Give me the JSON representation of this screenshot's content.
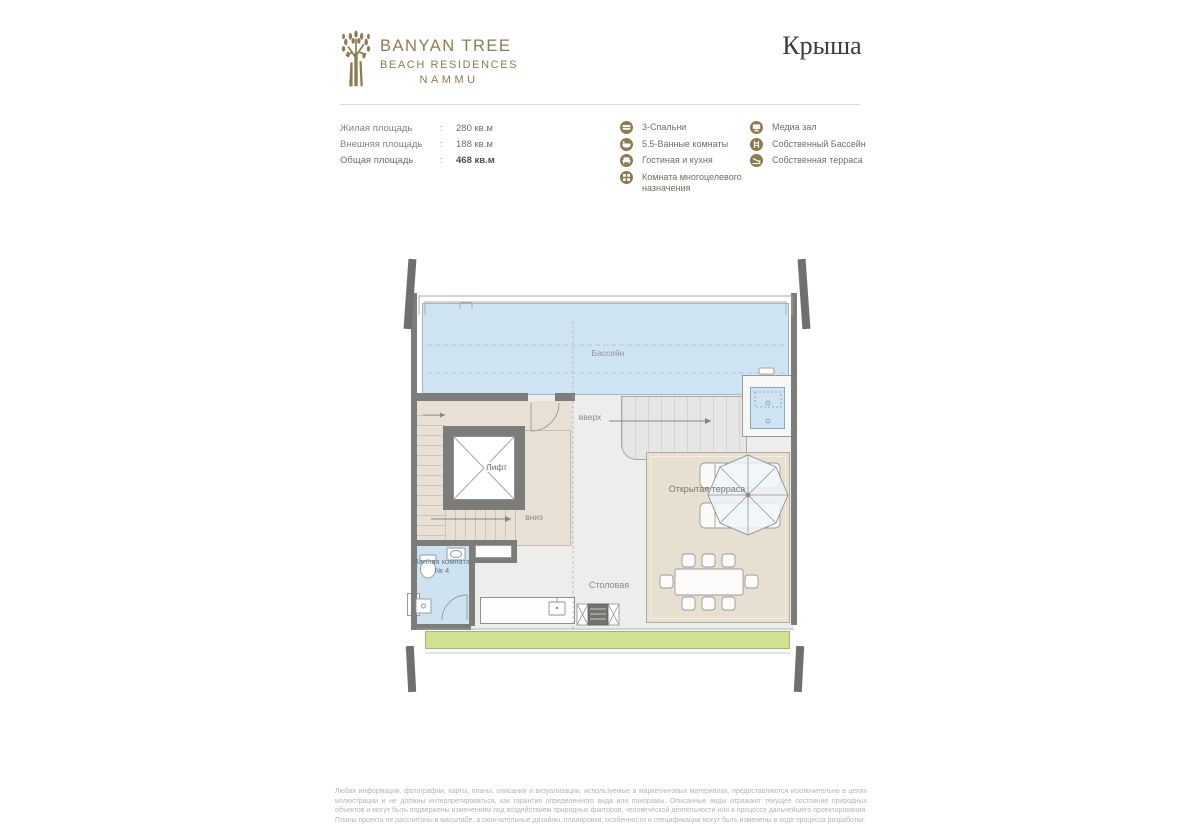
{
  "header": {
    "brand_line1": "BANYAN TREE",
    "brand_line2": "BEACH RESIDENCES",
    "brand_line3": "NAMMU",
    "title": "Крыша"
  },
  "areas": {
    "rows": [
      {
        "label": "Жилая площадь",
        "colon": ":",
        "value": "280 кв.м"
      },
      {
        "label": "Внешняя площадь",
        "colon": ":",
        "value": "188 кв.м"
      },
      {
        "label": "Общая площадь",
        "colon": ":",
        "value": "468 кв.м"
      }
    ]
  },
  "legend": {
    "left": [
      {
        "icon": "bed-icon",
        "label": "3-Спальни"
      },
      {
        "icon": "bath-icon",
        "label": "5.5-Ванные комнаты"
      },
      {
        "icon": "sofa-icon",
        "label": "Гостиная и кухня"
      },
      {
        "icon": "multipurpose-icon",
        "label": "Комната многоцелевого назначения"
      }
    ],
    "right": [
      {
        "icon": "media-icon",
        "label": "Медиа зал"
      },
      {
        "icon": "pool-icon",
        "label": "Собственный Бассейн"
      },
      {
        "icon": "terrace-icon",
        "label": "Собственная терраса"
      }
    ]
  },
  "plan": {
    "labels": {
      "pool": "Бассейн",
      "up": "вверх",
      "elevator": "Лифт",
      "down": "вниз",
      "bathroom": "Ванная комната № 4",
      "dining": "Столовая",
      "terrace": "Открытая терраса"
    }
  },
  "colors": {
    "brand_gold": "#8d7c50",
    "pool_blue": "#cfe4f2",
    "bathroom_blue": "#cde3f0",
    "terrace_beige": "#e7dfd0",
    "planter_green": "#cfe292",
    "wall_gray": "#7c7c7a",
    "title_dark": "#3c3c3c"
  },
  "footer": {
    "disclaimer": "Любая информация, фотографии, карты, планы, описания и визуализации, используемые в маркетинговых материалах, предоставляются исключительно в целях иллюстрации и не должны интерпретироваться, как гарантия определенного вида или панорамы. Описанные виды отражают текущее состояние природных объектов и могут быть подвержены изменениям под воздействием природных факторов, человеческой деятельности или в процессе дальнейшего проектирования. Планы проекта не рассчитаны в масштабе, а окончательные дизайны, планировки, особенности и спецификации могут быть изменены в ходе процесса разработки."
  }
}
